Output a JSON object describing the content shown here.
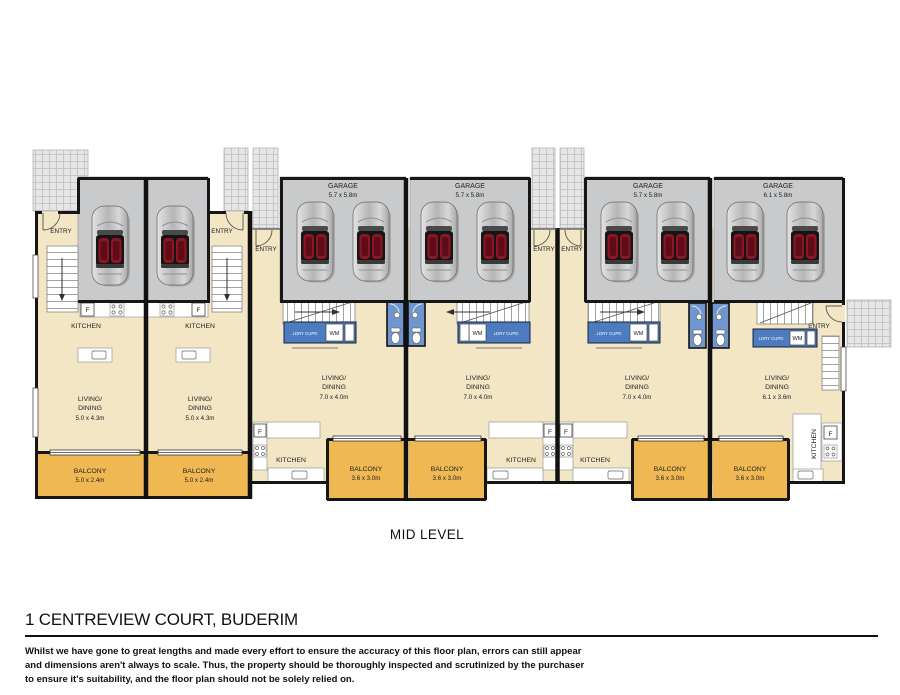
{
  "plan": {
    "level_label": "MID LEVEL",
    "labels": {
      "entry": "ENTRY",
      "kitchen": "KITCHEN",
      "garage": "GARAGE",
      "balcony": "BALCONY",
      "living_line1": "LIVING/",
      "living_line2": "DINING",
      "laundry_cupboard": "LDRY CUPD",
      "washing_machine": "WM",
      "fridge": "F"
    },
    "units": [
      {
        "name": "unit-1",
        "living_dims": "5.0 x 4.3m",
        "balcony_dims": "5.0 x 2.4m"
      },
      {
        "name": "unit-2",
        "living_dims": "5.0 x 4.3m",
        "balcony_dims": "5.0 x 2.4m"
      },
      {
        "name": "unit-3",
        "garage_dims": "5.7 x 5.8m",
        "living_dims": "7.0 x 4.0m",
        "balcony_dims": "3.6 x 3.0m"
      },
      {
        "name": "unit-4",
        "garage_dims": "5.7 x 5.8m",
        "living_dims": "7.0 x 4.0m",
        "balcony_dims": "3.6 x 3.0m"
      },
      {
        "name": "unit-5",
        "garage_dims": "5.7 x 5.8m",
        "living_dims": "7.0 x 4.0m",
        "balcony_dims": "3.6 x 3.0m"
      },
      {
        "name": "unit-6",
        "garage_dims": "6.1 x 5.8m",
        "living_dims": "6.1 x 3.6m",
        "balcony_dims": "3.6 x 3.0m"
      }
    ]
  },
  "footer": {
    "address_title": "1 CENTREVIEW COURT, BUDERIM",
    "disclaimer_lines": [
      "Whilst we have gone to great lengths and made every effort to ensure the accuracy of this floor plan, errors can still appear",
      "and dimensions aren't always to scale. Thus, the property should be thoroughly inspected and scrutinized by the purchaser",
      "to ensure it's suitability, and the floor plan should not be solely relied on."
    ]
  },
  "colors": {
    "floor": "#F3E6C5",
    "garage": "#C9CACB",
    "balcony": "#F0B853",
    "cabinet_blue": "#4C7BBF",
    "wc_blue": "#7096D0",
    "wall": "#151515",
    "paving": "#E6E6E6",
    "car_seat_red": "#8E1524"
  }
}
